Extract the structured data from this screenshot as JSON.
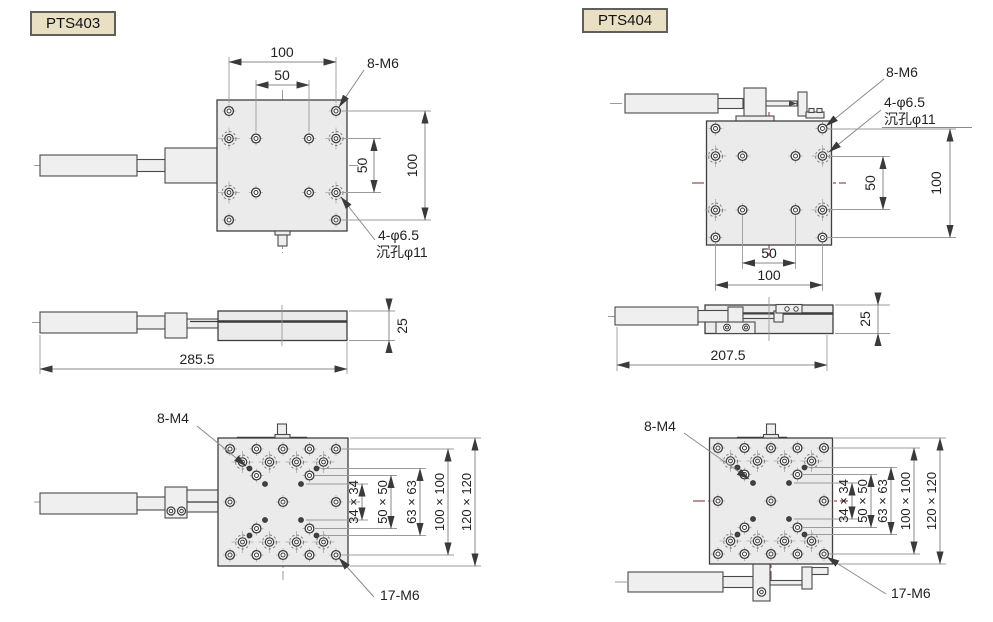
{
  "colors": {
    "centerline_gray": "#9a9a9a",
    "centerline_red": "#96504f",
    "plate_fill": "#ebebeb",
    "outline": "#3f3f3f",
    "dimension_line": "#8a8a8a",
    "label_box_fill": "#e9dfc2",
    "label_box_border": "#5f5f5f"
  },
  "panels": {
    "pts403": {
      "label": "PTS403",
      "top": {
        "w100": "100",
        "w50": "50",
        "m6": "8-M6",
        "h50": "50",
        "h100": "100",
        "phi": "4-φ6.5",
        "cbore": "沉孔φ11"
      },
      "side": {
        "len": "285.5",
        "h": "25"
      },
      "bottom": {
        "m4": "8-M4",
        "s34": "34 × 34",
        "s50": "50 × 50",
        "s63": "63 × 63",
        "s100": "100 × 100",
        "s120": "120 × 120",
        "m6": "17-M6"
      }
    },
    "pts404": {
      "label": "PTS404",
      "top": {
        "m6": "8-M6",
        "phi": "4-φ6.5",
        "cbore": "沉孔φ11",
        "h50": "50",
        "h100": "100",
        "w50": "50",
        "w100": "100"
      },
      "side": {
        "len": "207.5",
        "h": "25"
      },
      "bottom": {
        "m4": "8-M4",
        "s34": "34 × 34",
        "s50": "50 × 50",
        "s63": "63 × 63",
        "s100": "100 × 100",
        "s120": "120 × 120",
        "m6": "17-M6"
      }
    }
  }
}
